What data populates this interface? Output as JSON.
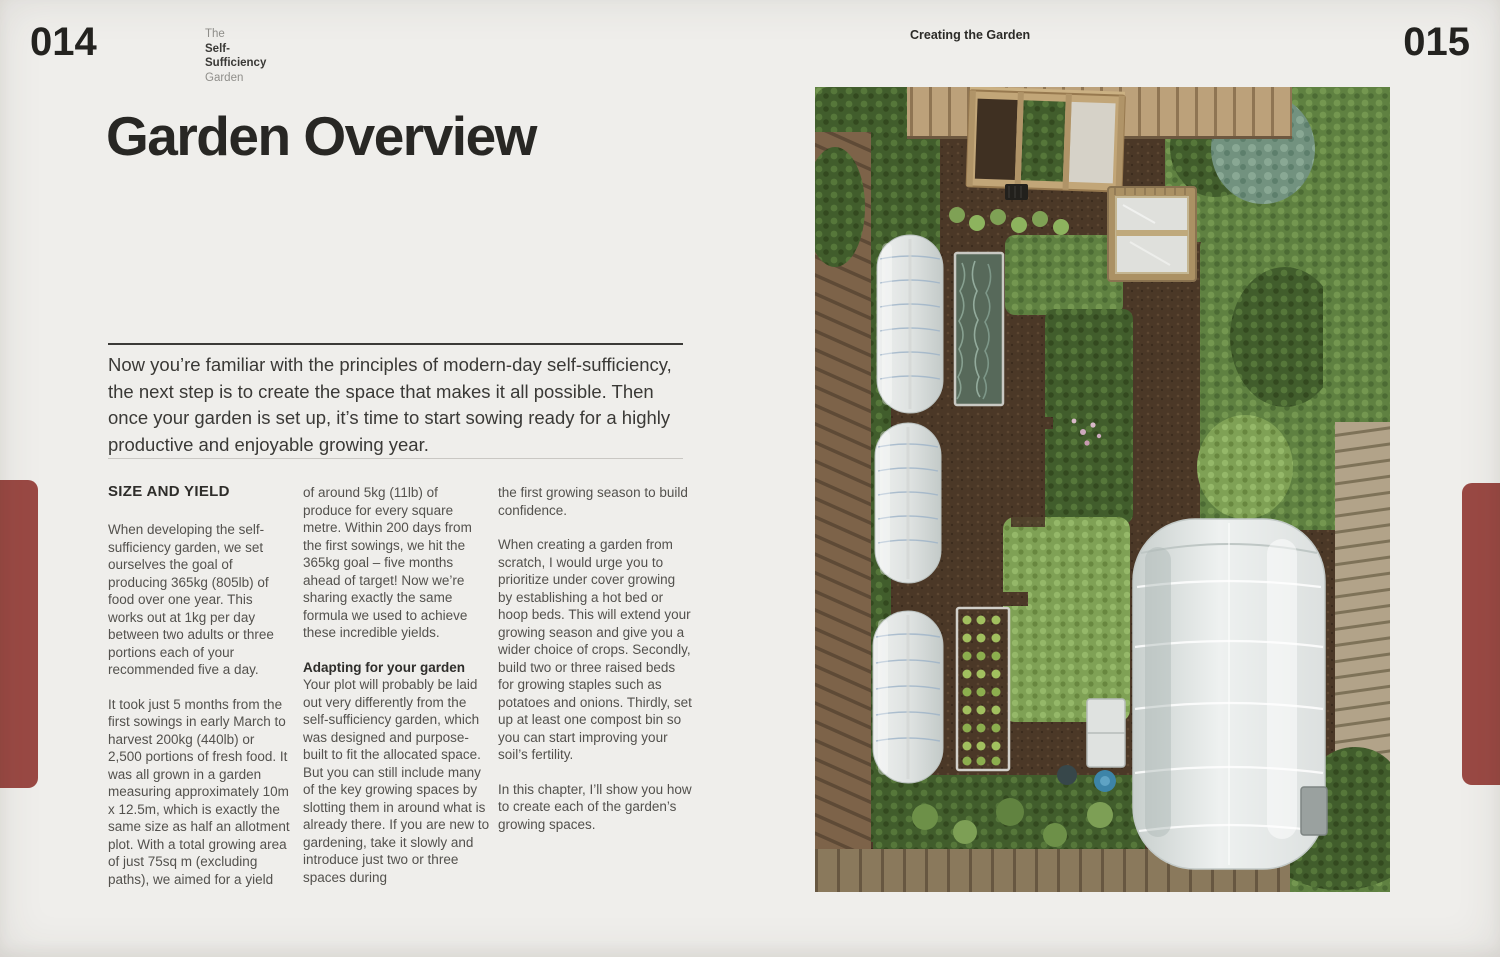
{
  "colors": {
    "page_background": "#efeeeb",
    "chapter_tab_red": "#9a4944",
    "text_dark": "#2c2b28",
    "text_body": "#53514d"
  },
  "left_page": {
    "page_number": "014",
    "book_title_line1": "The",
    "book_title_line2": "Self-",
    "book_title_line3": "Sufficiency",
    "book_title_line4": "Garden",
    "title": "Garden Overview",
    "intro": "Now you’re familiar with the principles of modern-day self-sufficiency, the next step is to create the space that makes it all possible. Then once your garden is set up, it’s time to start sowing ready for a highly productive and enjoyable growing year.",
    "col1": {
      "heading": "SIZE AND YIELD",
      "para1": "When developing the self-sufficiency garden, we set ourselves the goal of producing 365kg (805lb) of food over one year. This works out at 1kg per day between two adults or three portions each of your recommended five a day.",
      "para2": "It took just 5 months from the first sowings in early March to harvest 200kg (440lb) or 2,500 portions of fresh food. It was all grown in a garden measuring approximately 10m x 12.5m, which is exactly the same size as half an allotment plot. With a total growing area of just 75sq m (excluding paths), we aimed for a yield"
    },
    "col2": {
      "para1": "of around 5kg (11lb) of produce for every square metre. Within 200 days from the first sowings, we hit the 365kg goal – five months ahead of target! Now we’re sharing exactly the same formula we used to achieve these incredible yields.",
      "subheading": "Adapting for your garden",
      "para2": "Your plot will probably be laid out very differently from the self-sufficiency garden, which was designed and purpose-built to fit the allocated space. But you can still include many of the key growing spaces by slotting them in around what is already there. If you are new to gardening, take it slowly and introduce just two or three spaces during"
    },
    "col3": {
      "para1": "the first growing season to build confidence.",
      "para2": "When creating a garden from scratch, I would urge you to prioritize under cover growing by establishing a hot bed or hoop beds. This will extend your growing season and give you a wider choice of crops. Secondly, build two or three raised beds for growing staples such as potatoes and onions. Thirdly, set up at least one compost bin so you can start improving your soil’s fertility.",
      "para3": "In this chapter, I’ll show you how to create each of the garden’s growing spaces."
    }
  },
  "right_page": {
    "header": "Creating the Garden",
    "page_number": "015",
    "photo_alt": "Aerial view of the self-sufficiency garden: raised beds, compost bins, a cold frame, three white hoop tunnels, and a large polytunnel surrounded by wooden fences"
  }
}
